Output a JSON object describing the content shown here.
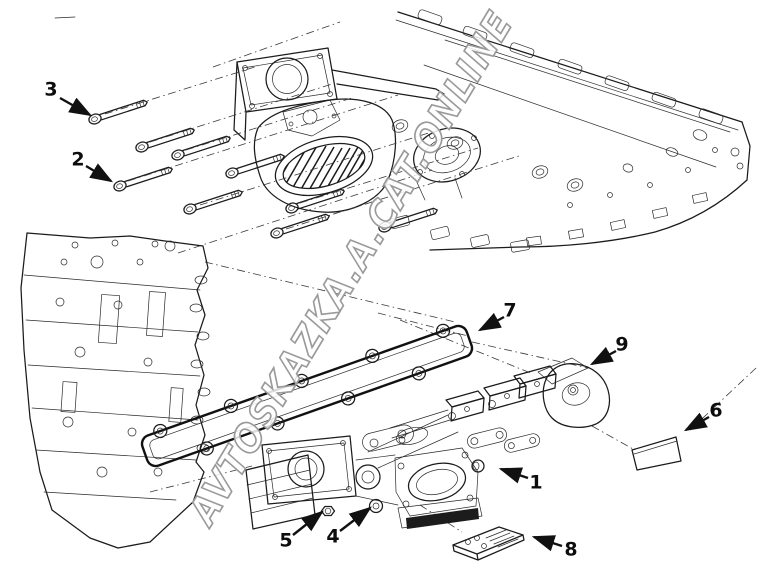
{
  "diagram": {
    "watermark": "AVTOSKAZKA.A.CAT.ONLINE",
    "callouts": [
      {
        "number": "1"
      },
      {
        "number": "2"
      },
      {
        "number": "3"
      },
      {
        "number": "4"
      },
      {
        "number": "5"
      },
      {
        "number": "6"
      },
      {
        "number": "7"
      },
      {
        "number": "8"
      },
      {
        "number": "9"
      }
    ]
  }
}
